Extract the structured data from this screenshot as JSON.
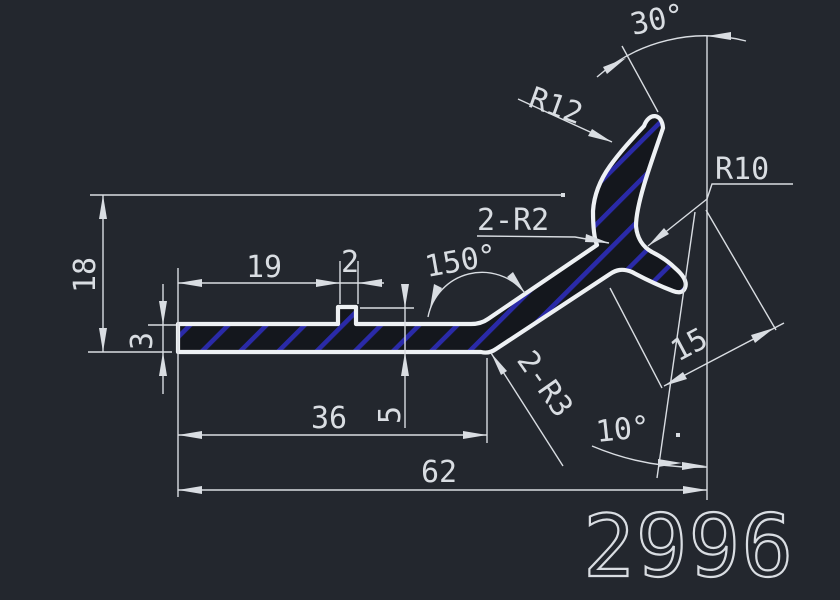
{
  "drawing": {
    "part_number": "2996",
    "background_color": "#23272e",
    "line_color": "#d9dde2",
    "hatch_color": "#2a2aa8",
    "labels": {
      "angle_top": "30°",
      "radius_hook_outer": "R12",
      "radius_hook_inner": "R10",
      "fillet_crotch": "2-R2",
      "angle_bend": "150°",
      "overall_height": "18",
      "length_to_rib": "19",
      "rib_width": "2",
      "wall_thickness": "3",
      "rib_height": "5",
      "length_to_bend": "36",
      "arm_length": "15",
      "fillet_bend": "2-R3",
      "angle_arm": "10°",
      "overall_length": "62"
    }
  }
}
